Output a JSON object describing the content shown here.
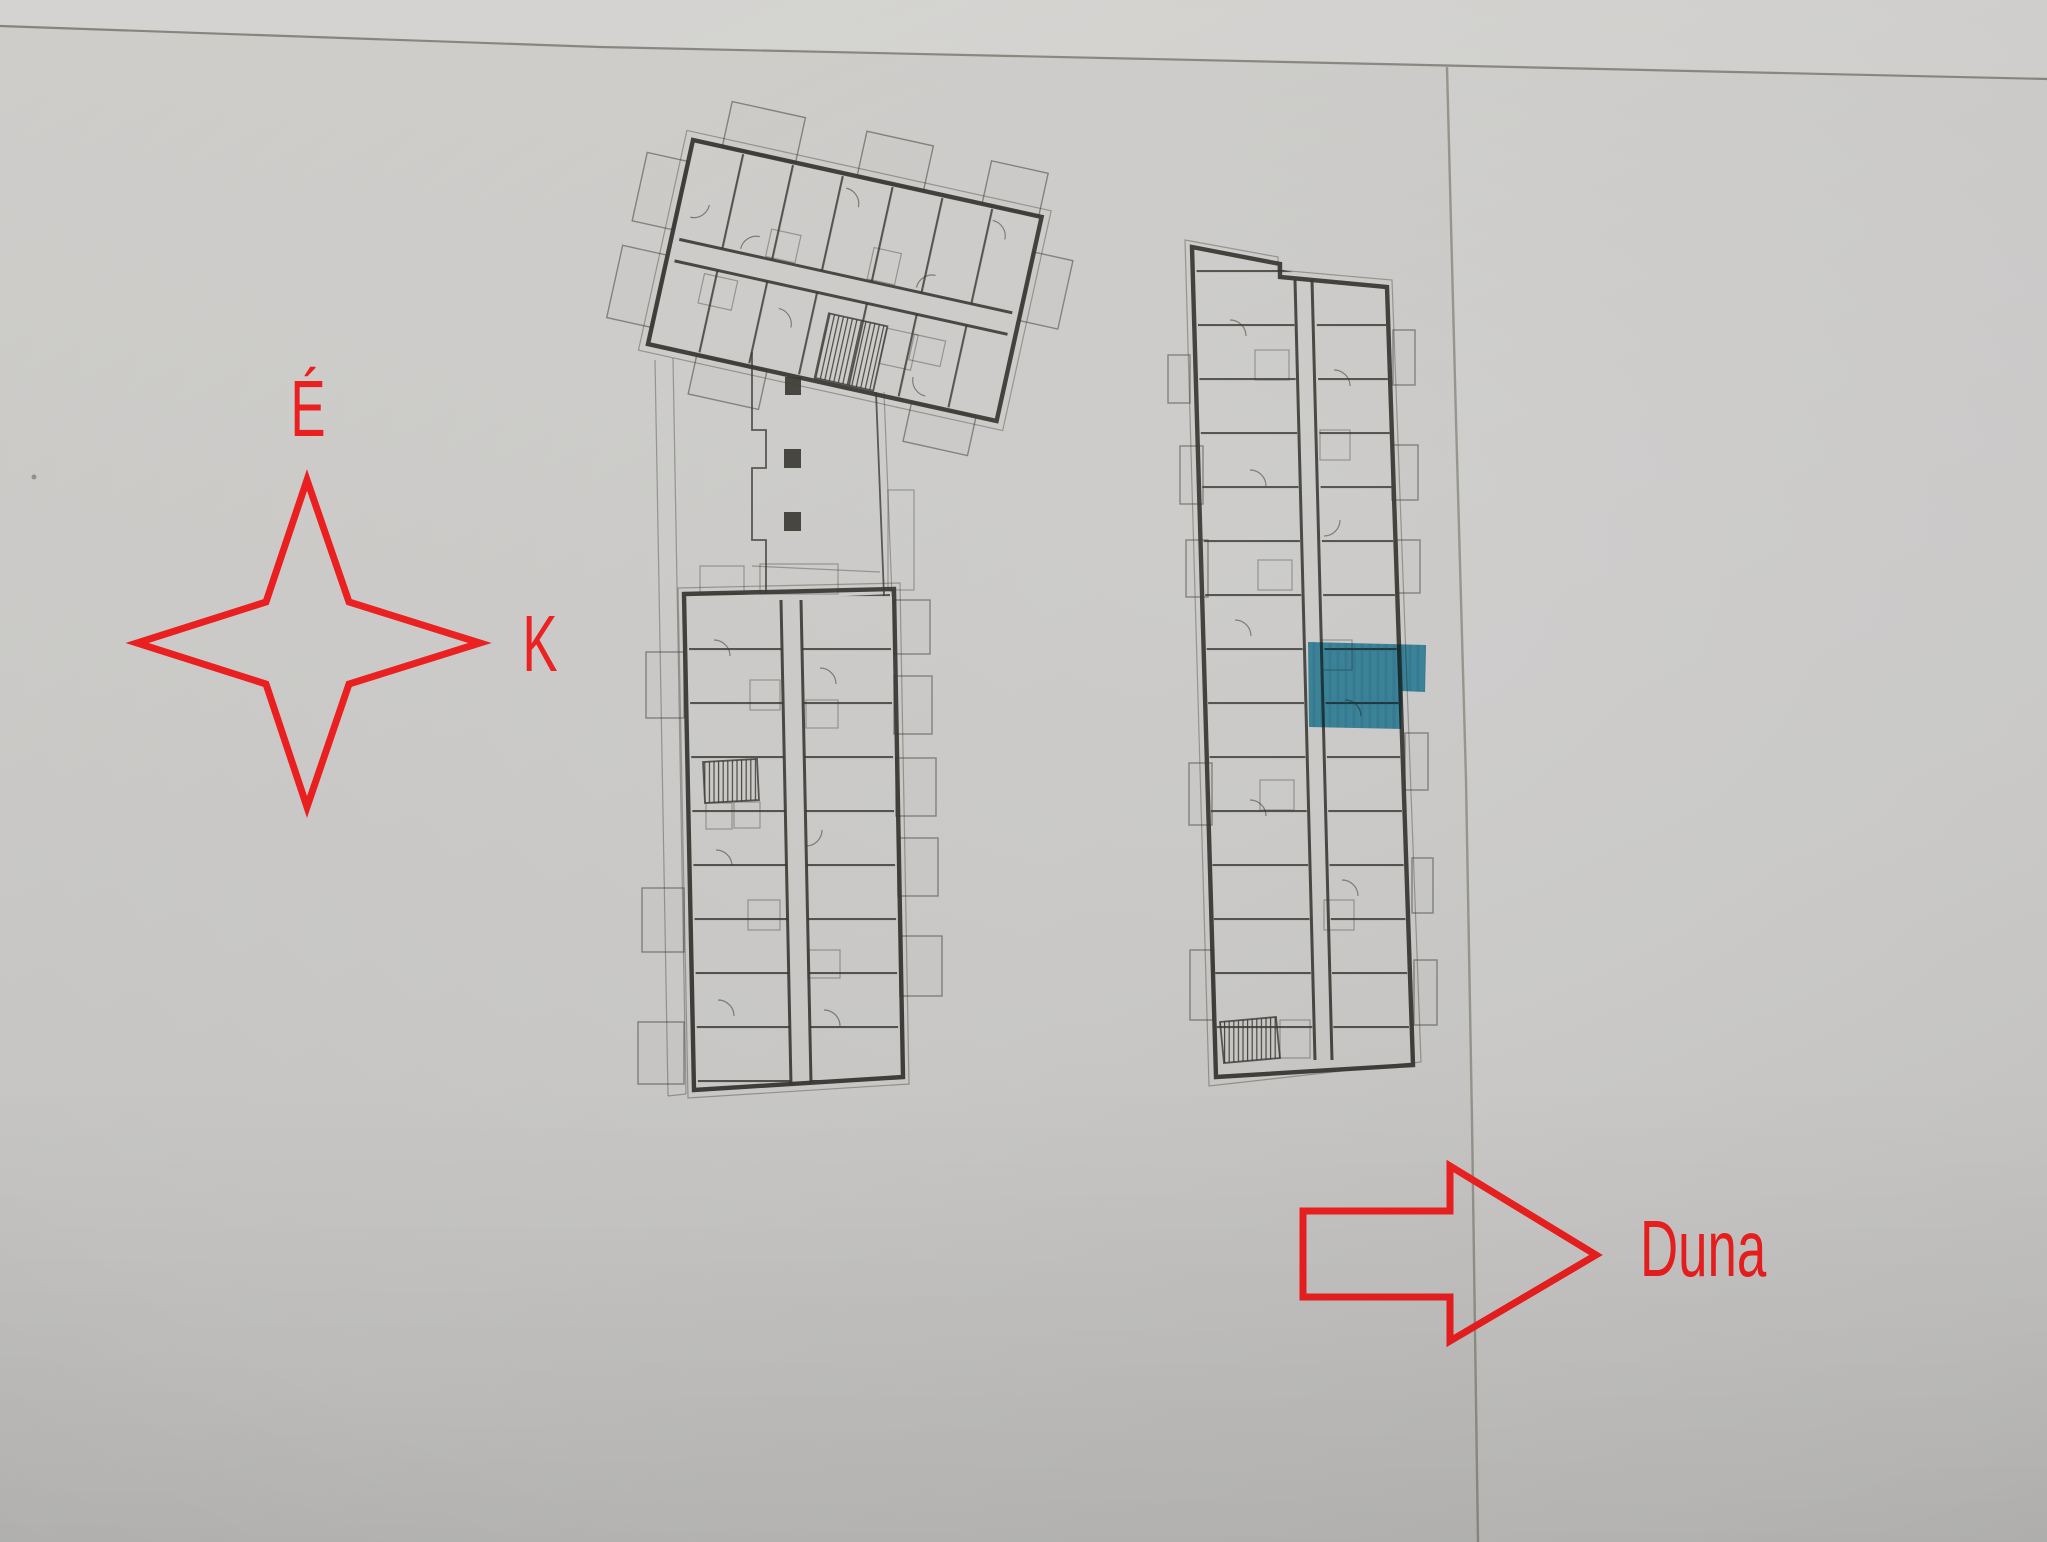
{
  "compass": {
    "north_label": "É",
    "east_label": "K"
  },
  "river_arrow": {
    "label": "Duna"
  },
  "colors": {
    "annotation_red": "#ed1c1c",
    "highlight_teal": "#2b95b6",
    "plan_ink": "#35332e",
    "paper_gray": "#c9c8c6",
    "paper_edge": "#7e7e75"
  }
}
